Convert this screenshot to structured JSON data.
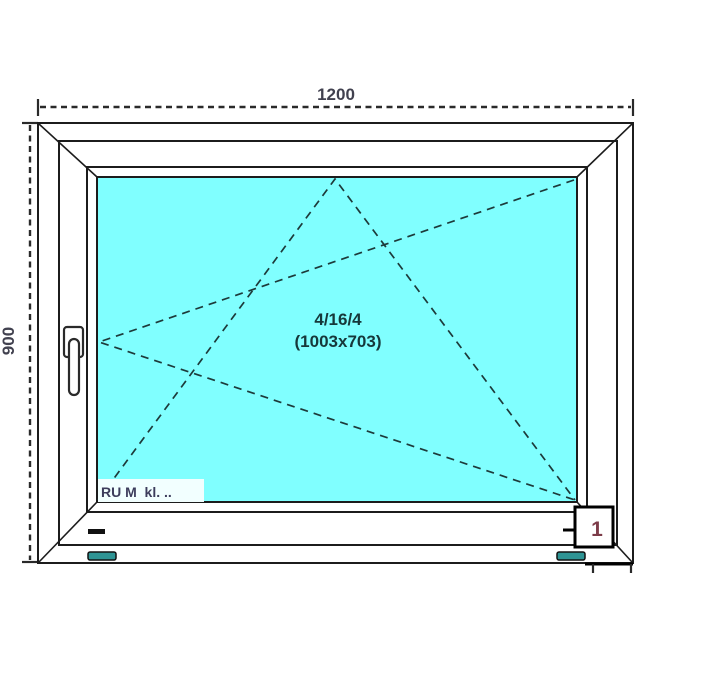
{
  "drawing": {
    "type_label": "window-technical-drawing",
    "dimensions": {
      "width_label": "1200",
      "height_label": "900"
    },
    "glazing": {
      "spec": "4/16/4",
      "size": "(1003x703)"
    },
    "profile_label": "RU M  kl. ..",
    "detail_marker": "1",
    "colors": {
      "glass": "#80ffff",
      "label_bg": "#f2ffff",
      "symbol_line": "#1d3a3a",
      "glazing_text": "#16383a",
      "dim_text": "#41414f",
      "profile_text": "#3d3d5c",
      "detail_text": "#7d3c49",
      "drain_slot": "#2e9494"
    }
  }
}
